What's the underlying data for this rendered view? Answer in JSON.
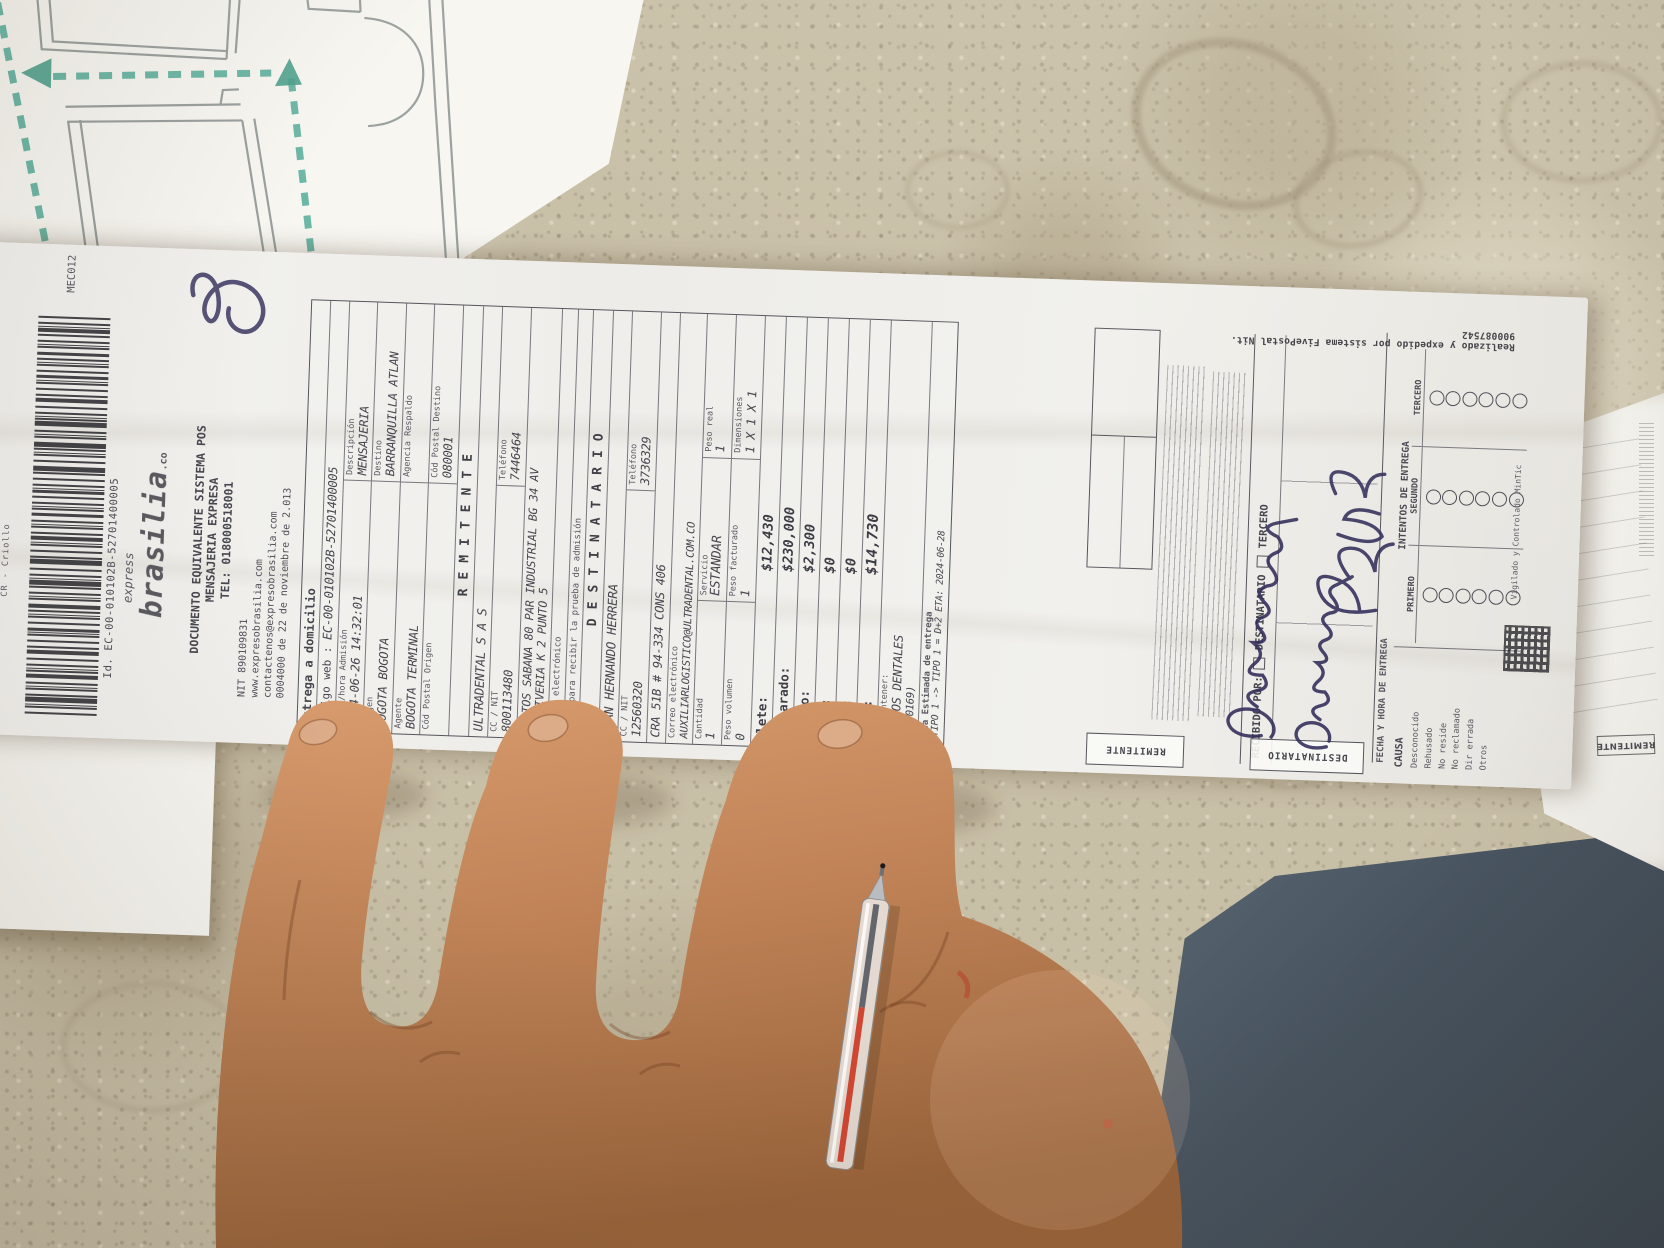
{
  "receipt": {
    "corner_code": "MEC012",
    "side_label": "CR - Criollo",
    "barcode_number": "Id. EC-00-010102B-52701400005",
    "logo": {
      "pre": "express",
      "name": "brasilia",
      "suffix": ".co"
    },
    "header": {
      "line1": "DOCUMENTO EQUIVALENTE SISTEMA POS",
      "line2": "MENSAJERIA EXPRESA",
      "line3": "TEL: 018000518001",
      "nit": "NIT 890109831",
      "web": "www.expresobrasilia.com",
      "email": "contactenos@expresobrasilia.com",
      "resolucion": "0004000 de 22 de noviembre de 2.013"
    },
    "envio": {
      "entrega": "Entrega a domicilio",
      "codigo_web_label": "Código web :",
      "codigo_web": "EC-00-010102B-52701400005",
      "fecha_label": "Fecha/hora Admisión",
      "fecha": "2024-06-26 14:32:01",
      "descripcion_label": "Descripción",
      "descripcion": "MENSAJERIA",
      "origen_label": "Origen",
      "origen": "BOGOTA BOGOTA",
      "destino_label": "Destino",
      "destino": "BARRANQUILLA ATLAN",
      "agente_label": "Agente",
      "agente": "BOGOTA TERMINAL",
      "agencia_label": "Agencia Respaldo",
      "cp_origen_label": "Cód Postal Origen",
      "cp_destino_label": "Cód Postal Destino",
      "cp_destino": "080001"
    },
    "remitente": {
      "titulo": "REMITENTE",
      "nombre": "ULTRADENTAL S A S",
      "cc_label": "CC / NIT",
      "cc": "800113480",
      "tel_label": "Teléfono",
      "tel": "7446464",
      "direccion1": "PORTOS SABANA 80 PAR INDUSTRIAL BG 34 AV",
      "direccion2": "LA SIVERIA K 2 PUNTO 5",
      "correo_label": "Correo electrónico",
      "medio_label": "Medio para recibir la prueba de admisión"
    },
    "destinatario": {
      "titulo": "DESTINATARIO",
      "nombre": "IVAN HERNANDO HERRERA",
      "cc_label": "CC / NIT",
      "cc": "12560320",
      "tel_label": "Teléfono",
      "tel": "3736329",
      "direccion": "CRA 51B # 94-334 CONS 406",
      "correo_label": "Correo electrónico",
      "correo": "AUXILIARLOGISTICO@ULTRADENTAL.COM.CO"
    },
    "paquete": {
      "cantidad_label": "Cantidad",
      "cantidad": "1",
      "servicio_label": "Servicio",
      "servicio": "ESTANDAR",
      "peso_real_label": "Peso real",
      "peso_real": "1",
      "peso_vol_label": "Peso volumen",
      "peso_vol": "0",
      "peso_fact_label": "Peso facturado",
      "peso_fact": "1",
      "dim_label": "Dimensiones",
      "dim": "1 X 1 X 1"
    },
    "valores": {
      "rows": [
        {
          "label": "Flete:",
          "value": "$12,430"
        },
        {
          "label": "Declarado:",
          "value": "$230,000"
        },
        {
          "label": "Seguro:",
          "value": "$2,300"
        },
        {
          "label": "Otros:",
          "value": "$0"
        },
        {
          "label": "Reexp:",
          "value": "$0"
        },
        {
          "label": "Total:",
          "value": "$14,730"
        }
      ]
    },
    "contenido": {
      "dice_label": "Dice contener:",
      "contenido": "INSUMOS DENTALES",
      "codigo": "(20170169)",
      "eta_label": "Fecha Estimada de entrega",
      "eta": "3 TIPO 1 -> TIPO 1 = D+2 ETA: 2024-06-28"
    },
    "stub": {
      "remitente_tab": "REMITENTE",
      "destinatario_tab": "DESTINATARIO",
      "recibido_label": "RECIBIDO POR:",
      "chk_destinatario": "DESTINATARIO",
      "chk_tercero": "TERCERO",
      "fecha_entrega_label": "FECHA Y HORA DE ENTREGA",
      "intentos_title": "INTENTOS DE ENTREGA",
      "intentos_cols": [
        "PRIMERO",
        "SEGUNDO",
        "TERCERO"
      ],
      "causa_label": "CAUSA",
      "causas": [
        "Desconocido",
        "Rehusado",
        "No reside",
        "No reclamado",
        "Dir errada",
        "Otros"
      ],
      "vigilado": "Vigilado y Controlado MinTic",
      "sistema_line": "Realizado y expedido por sistema FivePostal Nit. 900087542",
      "handwriting": {
        "line1": "Maicolyns",
        "line2": "Cervantes",
        "line3": "3077703"
      }
    }
  },
  "copy_sheet": {
    "remitente_tab": "REMITENTE"
  },
  "colors": {
    "route_teal": "#54ac99",
    "pen_ink_blue": "#35305c",
    "pen_red": "#cf4733",
    "stone": "#c8bfa7",
    "dark_object": "#47535f"
  }
}
